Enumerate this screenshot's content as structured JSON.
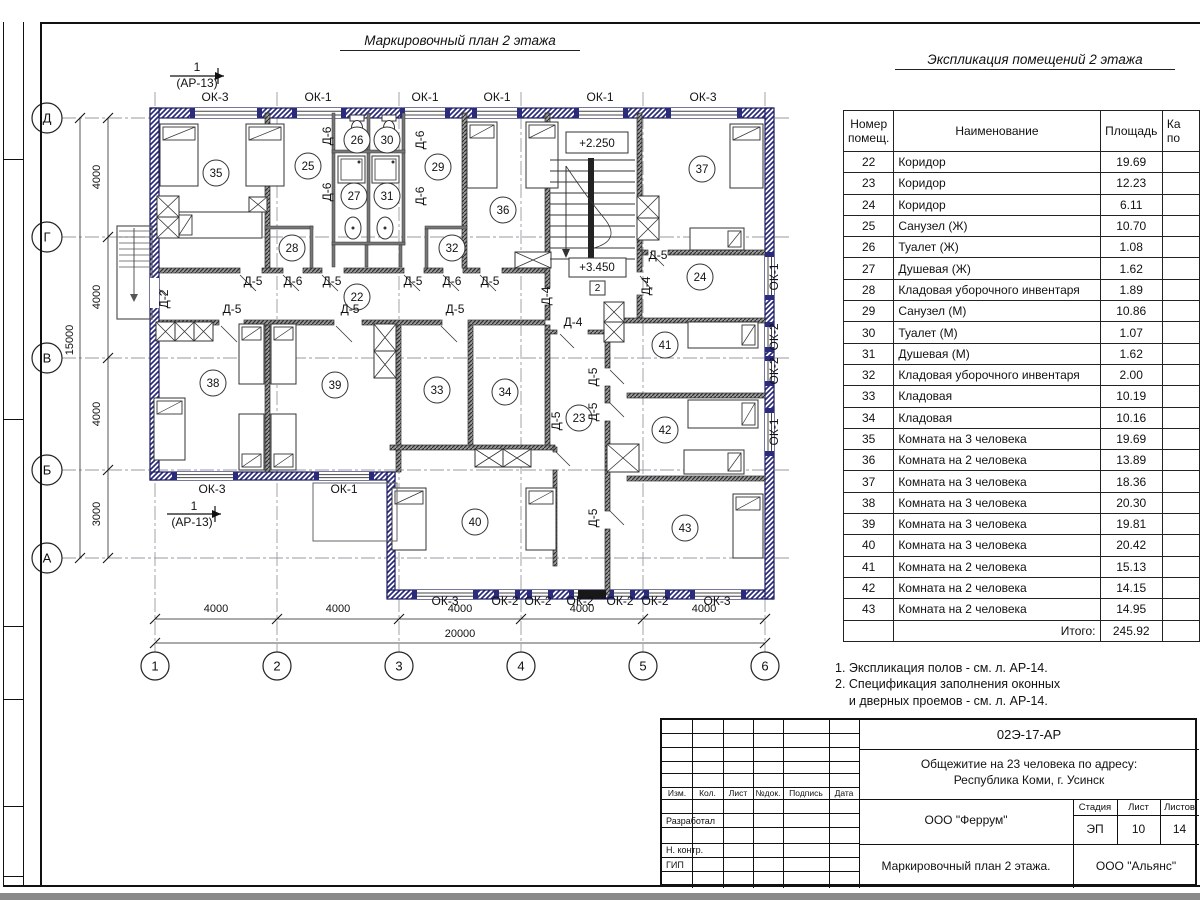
{
  "sheet": {
    "plan_title": "Маркировочный план 2 этажа",
    "table_title": "Экспликация помещений 2 этажа",
    "notes": [
      "1. Экспликация полов - см. л. АР-14.",
      "2. Спецификация заполнения оконных",
      "    и дверных проемов - см. л. АР-14."
    ]
  },
  "explication": {
    "col_number": [
      "Номер",
      "помещ."
    ],
    "col_name": "Наименование",
    "col_area": "Площадь",
    "col_cut": [
      "Ка",
      "по"
    ],
    "rows": [
      {
        "n": "22",
        "name": "Коридор",
        "area": "19.69"
      },
      {
        "n": "23",
        "name": "Коридор",
        "area": "12.23"
      },
      {
        "n": "24",
        "name": "Коридор",
        "area": "6.11"
      },
      {
        "n": "25",
        "name": "Санузел (Ж)",
        "area": "10.70"
      },
      {
        "n": "26",
        "name": "Туалет (Ж)",
        "area": "1.08"
      },
      {
        "n": "27",
        "name": "Душевая (Ж)",
        "area": "1.62"
      },
      {
        "n": "28",
        "name": "Кладовая уборочного инвентаря",
        "area": "1.89"
      },
      {
        "n": "29",
        "name": "Санузел (М)",
        "area": "10.86"
      },
      {
        "n": "30",
        "name": "Туалет (М)",
        "area": "1.07"
      },
      {
        "n": "31",
        "name": "Душевая (М)",
        "area": "1.62"
      },
      {
        "n": "32",
        "name": "Кладовая уборочного инвентаря",
        "area": "2.00"
      },
      {
        "n": "33",
        "name": "Кладовая",
        "area": "10.19"
      },
      {
        "n": "34",
        "name": "Кладовая",
        "area": "10.16"
      },
      {
        "n": "35",
        "name": "Комната на 3 человека",
        "area": "19.69"
      },
      {
        "n": "36",
        "name": "Комната на 2 человека",
        "area": "13.89"
      },
      {
        "n": "37",
        "name": "Комната на 3 человека",
        "area": "18.36"
      },
      {
        "n": "38",
        "name": "Комната на 3 человека",
        "area": "20.30"
      },
      {
        "n": "39",
        "name": "Комната на 3 человека",
        "area": "19.81"
      },
      {
        "n": "40",
        "name": "Комната на 3 человека",
        "area": "20.42"
      },
      {
        "n": "41",
        "name": "Комната на 2 человека",
        "area": "15.13"
      },
      {
        "n": "42",
        "name": "Комната на 2 человека",
        "area": "14.15"
      },
      {
        "n": "43",
        "name": "Комната на 2 человека",
        "area": "14.95"
      }
    ],
    "total_label": "Итого:",
    "total_value": "245.92"
  },
  "title_block": {
    "doc_number": "02Э-17-АР",
    "project_line1": "Общежитие на 23 человека по адресу:",
    "project_line2": "Республика Коми, г. Усинск",
    "designer_org": "ООО \"Феррум\"",
    "drawing_name": "Маркировочный план 2 этажа.",
    "client_org": "ООО \"Альянс\"",
    "stage_label": "Стадия",
    "stage": "ЭП",
    "sheet_label": "Лист",
    "sheet": "10",
    "sheets_label": "Листов",
    "sheets": "14",
    "cols": [
      "Изм.",
      "Кол.",
      "Лист",
      "№док.",
      "Подпись",
      "Дата"
    ],
    "row_developed": "Разработал",
    "row_ncontr": "Н. контр.",
    "row_gip": "ГИП"
  },
  "plan": {
    "axis_rows": [
      {
        "t": "Д",
        "y": 118
      },
      {
        "t": "Г",
        "y": 237
      },
      {
        "t": "В",
        "y": 358
      },
      {
        "t": "Б",
        "y": 470
      },
      {
        "t": "А",
        "y": 558
      }
    ],
    "axis_cols": [
      {
        "t": "1",
        "x": 155
      },
      {
        "t": "2",
        "x": 277
      },
      {
        "t": "3",
        "x": 399
      },
      {
        "t": "4",
        "x": 521
      },
      {
        "t": "5",
        "x": 643
      },
      {
        "t": "6",
        "x": 765
      }
    ],
    "rooms": [
      {
        "n": "35",
        "x": 216,
        "y": 173
      },
      {
        "n": "25",
        "x": 308,
        "y": 166
      },
      {
        "n": "26",
        "x": 357,
        "y": 140
      },
      {
        "n": "30",
        "x": 387,
        "y": 140
      },
      {
        "n": "27",
        "x": 354,
        "y": 196
      },
      {
        "n": "31",
        "x": 387,
        "y": 196
      },
      {
        "n": "28",
        "x": 292,
        "y": 248
      },
      {
        "n": "29",
        "x": 438,
        "y": 167
      },
      {
        "n": "32",
        "x": 452,
        "y": 248
      },
      {
        "n": "36",
        "x": 503,
        "y": 210
      },
      {
        "n": "37",
        "x": 702,
        "y": 169
      },
      {
        "n": "24",
        "x": 700,
        "y": 277
      },
      {
        "n": "22",
        "x": 357,
        "y": 297
      },
      {
        "n": "38",
        "x": 213,
        "y": 383
      },
      {
        "n": "39",
        "x": 335,
        "y": 385
      },
      {
        "n": "33",
        "x": 437,
        "y": 390
      },
      {
        "n": "34",
        "x": 505,
        "y": 392
      },
      {
        "n": "23",
        "x": 579,
        "y": 418
      },
      {
        "n": "41",
        "x": 665,
        "y": 345
      },
      {
        "n": "42",
        "x": 665,
        "y": 430
      },
      {
        "n": "40",
        "x": 475,
        "y": 522
      },
      {
        "n": "43",
        "x": 685,
        "y": 528
      }
    ],
    "labels": [
      {
        "t": "ОК-3",
        "x": 215,
        "y": 101
      },
      {
        "t": "ОК-1",
        "x": 318,
        "y": 101
      },
      {
        "t": "ОК-1",
        "x": 425,
        "y": 101
      },
      {
        "t": "ОК-1",
        "x": 497,
        "y": 101
      },
      {
        "t": "ОК-1",
        "x": 600,
        "y": 101
      },
      {
        "t": "ОК-3",
        "x": 703,
        "y": 101
      },
      {
        "t": "ОК-3",
        "x": 212,
        "y": 493
      },
      {
        "t": "ОК-1",
        "x": 344,
        "y": 493
      },
      {
        "t": "ОК-3",
        "x": 445,
        "y": 605
      },
      {
        "t": "ОК-2",
        "x": 505,
        "y": 605
      },
      {
        "t": "ОК-2",
        "x": 538,
        "y": 605
      },
      {
        "t": "ОК-2",
        "x": 580,
        "y": 605
      },
      {
        "t": "ОК-2",
        "x": 620,
        "y": 605
      },
      {
        "t": "ОК-2",
        "x": 655,
        "y": 605
      },
      {
        "t": "ОК-3",
        "x": 717,
        "y": 605
      },
      {
        "t": "ОК-1",
        "x": 778,
        "y": 277,
        "r": -90
      },
      {
        "t": "ОК-2",
        "x": 778,
        "y": 337,
        "r": -90
      },
      {
        "t": "ОК-2",
        "x": 778,
        "y": 371,
        "r": -90
      },
      {
        "t": "ОК-1",
        "x": 778,
        "y": 432,
        "r": -90
      },
      {
        "t": "Д-5",
        "x": 253,
        "y": 285
      },
      {
        "t": "Д-6",
        "x": 293,
        "y": 285
      },
      {
        "t": "Д-5",
        "x": 332,
        "y": 285
      },
      {
        "t": "Д-5",
        "x": 413,
        "y": 285
      },
      {
        "t": "Д-6",
        "x": 452,
        "y": 285
      },
      {
        "t": "Д-5",
        "x": 490,
        "y": 285
      },
      {
        "t": "Д-5",
        "x": 658,
        "y": 259
      },
      {
        "t": "Д-5",
        "x": 232,
        "y": 313
      },
      {
        "t": "Д-5",
        "x": 350,
        "y": 313
      },
      {
        "t": "Д-5",
        "x": 455,
        "y": 313
      },
      {
        "t": "Д-4",
        "x": 573,
        "y": 326
      },
      {
        "t": "Д-6",
        "x": 331,
        "y": 136,
        "r": -90
      },
      {
        "t": "Д-6",
        "x": 331,
        "y": 192,
        "r": -90
      },
      {
        "t": "Д-6",
        "x": 424,
        "y": 140,
        "r": -90
      },
      {
        "t": "Д-6",
        "x": 424,
        "y": 196,
        "r": -90
      },
      {
        "t": "Д-2",
        "x": 168,
        "y": 299,
        "r": -90
      },
      {
        "t": "Д-4",
        "x": 550,
        "y": 296,
        "r": -90
      },
      {
        "t": "Д-4",
        "x": 650,
        "y": 286,
        "r": -90
      },
      {
        "t": "Д-5",
        "x": 560,
        "y": 421,
        "r": -90
      },
      {
        "t": "Д-5",
        "x": 597,
        "y": 377,
        "r": -90
      },
      {
        "t": "Д-5",
        "x": 597,
        "y": 412,
        "r": -90
      },
      {
        "t": "Д-5",
        "x": 597,
        "y": 518,
        "r": -90
      },
      {
        "t": "4000",
        "x": 100,
        "y": 177,
        "r": -90,
        "cls": "dim"
      },
      {
        "t": "4000",
        "x": 100,
        "y": 297,
        "r": -90,
        "cls": "dim"
      },
      {
        "t": "4000",
        "x": 100,
        "y": 414,
        "r": -90,
        "cls": "dim"
      },
      {
        "t": "3000",
        "x": 100,
        "y": 514,
        "r": -90,
        "cls": "dim"
      },
      {
        "t": "15000",
        "x": 73,
        "y": 340,
        "r": -90,
        "cls": "dim"
      },
      {
        "t": "4000",
        "x": 216,
        "y": 612,
        "cls": "dim"
      },
      {
        "t": "4000",
        "x": 338,
        "y": 612,
        "cls": "dim"
      },
      {
        "t": "4000",
        "x": 460,
        "y": 612,
        "cls": "dim"
      },
      {
        "t": "4000",
        "x": 582,
        "y": 612,
        "cls": "dim"
      },
      {
        "t": "4000",
        "x": 704,
        "y": 612,
        "cls": "dim"
      },
      {
        "t": "20000",
        "x": 460,
        "y": 637,
        "cls": "dim"
      },
      {
        "t": "+2.250",
        "x": 597,
        "y": 147,
        "cls": "elev"
      },
      {
        "t": "+3.450",
        "x": 597,
        "y": 271,
        "cls": "elev"
      },
      {
        "t": "2",
        "x": 597.5,
        "y": 291,
        "cls": "small"
      },
      {
        "t": "1",
        "x": 197,
        "y": 71,
        "cls": "sec"
      },
      {
        "t": "(АР-13)",
        "x": 197,
        "y": 87,
        "cls": "sec"
      },
      {
        "t": "1",
        "x": 194,
        "y": 510,
        "cls": "sec"
      },
      {
        "t": "(АР-13)",
        "x": 192,
        "y": 526,
        "cls": "sec"
      }
    ]
  },
  "colors": {
    "wall_exterior": "#2b2b7e",
    "wall_exterior_dark": "#1c1c5e",
    "wall_interior": "#555555",
    "line": "#111111",
    "axis_line": "#9a9aa0"
  }
}
